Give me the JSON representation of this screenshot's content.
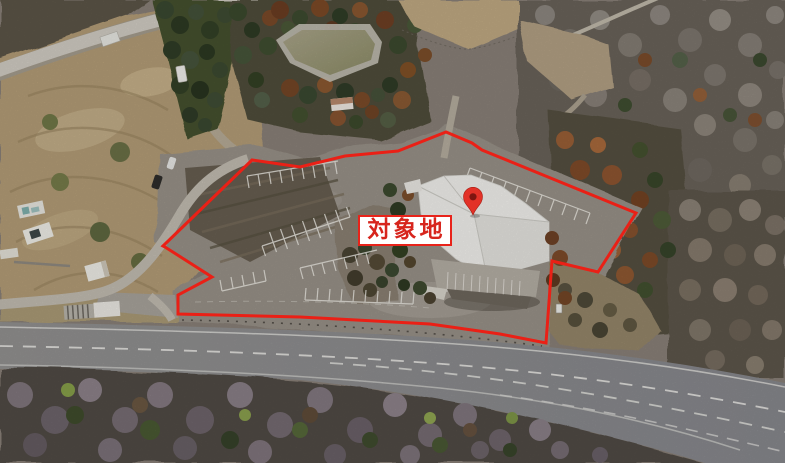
{
  "annotation": {
    "site_label": "対象地",
    "pin_icon": "location-pin",
    "colors": {
      "boundary": "#ea2016",
      "label_text": "#d7251d",
      "label_border": "#e8231a",
      "label_background": "#ffffff",
      "pin": "#e23127",
      "pin_inner": "#7e1510"
    }
  }
}
